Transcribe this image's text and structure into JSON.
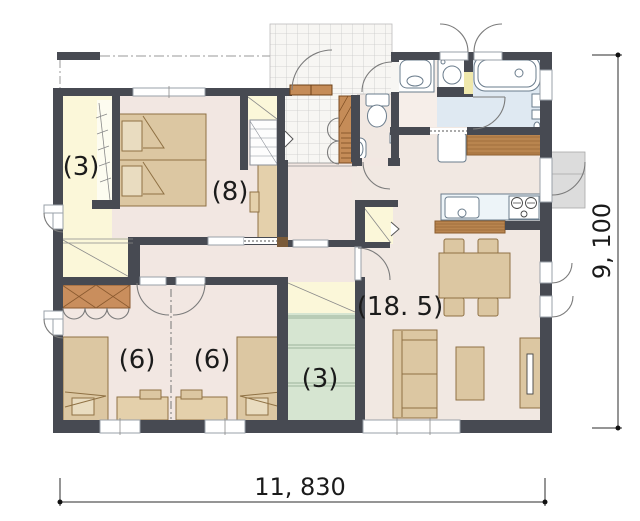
{
  "plan_title": "single-story house floor plan",
  "rooms": {
    "walk_in_closet": {
      "label": "(3)"
    },
    "main_bedroom": {
      "label": "(8)"
    },
    "bedroom_west": {
      "label": "(6)"
    },
    "bedroom_east": {
      "label": "(6)"
    },
    "storage": {
      "label": "(3)"
    },
    "ldk": {
      "label": "(18. 5)"
    }
  },
  "dimensions": {
    "width": "11, 830",
    "height": "9, 100"
  },
  "fixtures": [
    "double-bed",
    "single-bed",
    "single-bed",
    "study-desk",
    "study-desk",
    "wall-desk",
    "hanger-rod",
    "shoe-cabinet",
    "toilet",
    "hand-basin",
    "vanity-sink",
    "washing-machine",
    "bathtub",
    "refrigerator",
    "kitchen-counter",
    "sink",
    "gas-stove",
    "wood-counter",
    "dining-table",
    "dining-chairs",
    "sofa",
    "coffee-table",
    "tv-board",
    "green-shelves",
    "entrance-porch-tiles",
    "back-porch-steps"
  ],
  "colors": {
    "wall": "#474a52",
    "floor": "#f2e7e2",
    "closet_yellow": "#fbf7d9",
    "storage_green": "#d6e5d1",
    "bath_blue": "#dfe9f2",
    "furniture_tan": "#dcc7a2",
    "cabinet_brown": "#c98e5d"
  }
}
